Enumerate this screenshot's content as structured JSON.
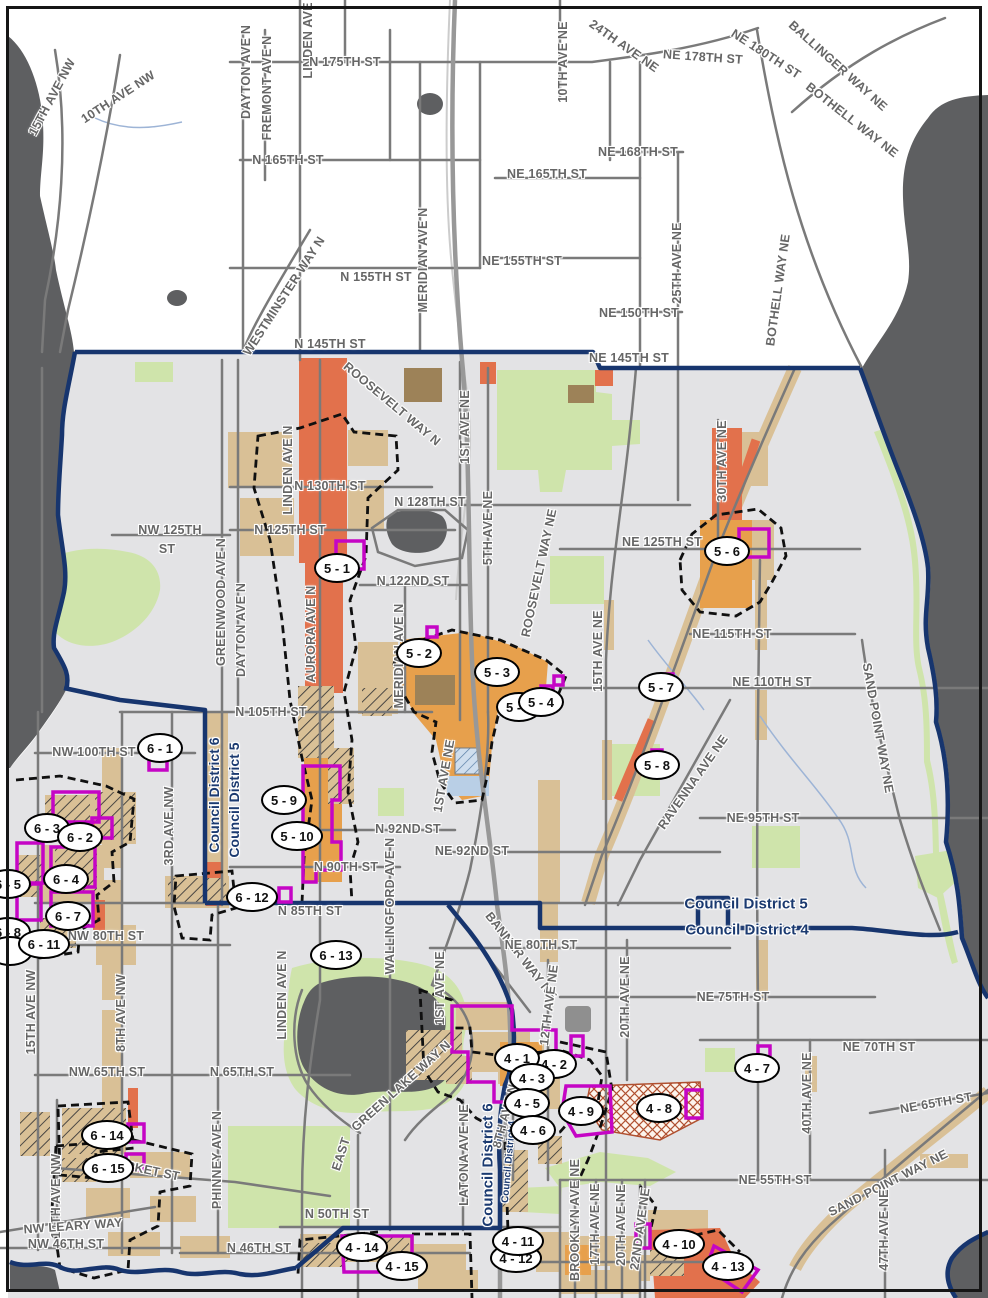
{
  "map": {
    "kind": "council-district-rezone-map",
    "colors": {
      "water": "#5e5f61",
      "city_background": "#e3e3e5",
      "outside_background": "#ffffff",
      "road": "#7a7a7a",
      "park_green": "#cfe4ab",
      "zone_tan": "#d9c096",
      "zone_orange": "#e2714c",
      "zone_amber": "#e7a04c",
      "zone_brown": "#9d8258",
      "district_boundary_navy": "#17356e",
      "zone_outline_purple": "#c505c5",
      "urban_village_dash": "#101010",
      "street_label_gray": "#666666",
      "district_label_blue": "#1b3a70",
      "stream_blue": "#9db4d6",
      "crosshatch_red": "#b05030",
      "school_blue": "#b9cfe6"
    }
  },
  "district_labels": [
    {
      "text": "Council District 6",
      "x": 214,
      "y": 795,
      "rot": -90,
      "size": 14
    },
    {
      "text": "Council District 5",
      "x": 234,
      "y": 800,
      "rot": -90,
      "size": 14
    },
    {
      "text": "Council District 5",
      "x": 746,
      "y": 904,
      "rot": 0,
      "size": 15
    },
    {
      "text": "Council District 4",
      "x": 747,
      "y": 930,
      "rot": 0,
      "size": 15
    },
    {
      "text": "Council District 6",
      "x": 488,
      "y": 1165,
      "rot": -90,
      "size": 15
    },
    {
      "text": "Council District 4",
      "x": 509,
      "y": 1162,
      "rot": -85,
      "size": 10
    }
  ],
  "street_labels": [
    {
      "text": "15TH AVE NW",
      "x": 52,
      "y": 97,
      "rot": -62
    },
    {
      "text": "10TH AVE NW",
      "x": 118,
      "y": 97,
      "rot": -33
    },
    {
      "text": "DAYTON AVE N",
      "x": 246,
      "y": 72,
      "rot": -90
    },
    {
      "text": "FREMONT AVE N",
      "x": 267,
      "y": 88,
      "rot": -90
    },
    {
      "text": "LINDEN AVE N",
      "x": 308,
      "y": 34,
      "rot": -90
    },
    {
      "text": "N 175TH ST",
      "x": 345,
      "y": 62,
      "rot": 0
    },
    {
      "text": "10TH AVE NE",
      "x": 563,
      "y": 62,
      "rot": -90
    },
    {
      "text": "24TH AVE NE",
      "x": 624,
      "y": 46,
      "rot": 35
    },
    {
      "text": "NE 178TH ST",
      "x": 703,
      "y": 57,
      "rot": 4
    },
    {
      "text": "NE 180TH ST",
      "x": 766,
      "y": 54,
      "rot": 33
    },
    {
      "text": "BALLINGER WAY NE",
      "x": 838,
      "y": 66,
      "rot": 42
    },
    {
      "text": "BOTHELL WAY NE",
      "x": 852,
      "y": 120,
      "rot": 38
    },
    {
      "text": "BOTHELL WAY NE",
      "x": 778,
      "y": 290,
      "rot": -82
    },
    {
      "text": "N 165TH ST",
      "x": 288,
      "y": 160,
      "rot": 0
    },
    {
      "text": "NE 168TH ST",
      "x": 638,
      "y": 152,
      "rot": 0
    },
    {
      "text": "NE 165TH ST",
      "x": 547,
      "y": 174,
      "rot": 0
    },
    {
      "text": "N 155TH ST",
      "x": 376,
      "y": 277,
      "rot": 0
    },
    {
      "text": "NE 155TH ST",
      "x": 522,
      "y": 261,
      "rot": 0
    },
    {
      "text": "NE 150TH ST",
      "x": 639,
      "y": 313,
      "rot": 0
    },
    {
      "text": "MERIDIAN AVE N",
      "x": 423,
      "y": 260,
      "rot": -90
    },
    {
      "text": "WESTMINSTER WAY N",
      "x": 284,
      "y": 296,
      "rot": -57
    },
    {
      "text": "N 145TH ST",
      "x": 330,
      "y": 344,
      "rot": 0
    },
    {
      "text": "NE 145TH ST",
      "x": 629,
      "y": 358,
      "rot": 0
    },
    {
      "text": "25TH AVE NE",
      "x": 677,
      "y": 263,
      "rot": -90
    },
    {
      "text": "ROOSEVELT WAY N",
      "x": 392,
      "y": 404,
      "rot": 40
    },
    {
      "text": "LINDEN AVE N",
      "x": 288,
      "y": 470,
      "rot": -90
    },
    {
      "text": "1ST AVE NE",
      "x": 465,
      "y": 427,
      "rot": -90
    },
    {
      "text": "5TH AVE NE",
      "x": 488,
      "y": 528,
      "rot": -90
    },
    {
      "text": "N 130TH ST",
      "x": 330,
      "y": 486,
      "rot": 0
    },
    {
      "text": "N 128TH ST",
      "x": 430,
      "y": 502,
      "rot": 0
    },
    {
      "text": "NW 125TH",
      "x": 170,
      "y": 530,
      "rot": 0
    },
    {
      "text": "ST",
      "x": 167,
      "y": 549,
      "rot": 0
    },
    {
      "text": "N 125TH ST",
      "x": 290,
      "y": 530,
      "rot": 0
    },
    {
      "text": "NE 125TH ST",
      "x": 662,
      "y": 542,
      "rot": 0
    },
    {
      "text": "N 122ND ST",
      "x": 413,
      "y": 581,
      "rot": 0
    },
    {
      "text": "GREENWOOD AVE N",
      "x": 221,
      "y": 602,
      "rot": -90
    },
    {
      "text": "DAYTON AVE N",
      "x": 241,
      "y": 630,
      "rot": -90
    },
    {
      "text": "AURORA AVE N",
      "x": 311,
      "y": 634,
      "rot": -90
    },
    {
      "text": "MERIDIAN AVE N",
      "x": 399,
      "y": 656,
      "rot": -90
    },
    {
      "text": "N 105TH ST",
      "x": 271,
      "y": 712,
      "rot": 0
    },
    {
      "text": "NW 100TH ST",
      "x": 94,
      "y": 752,
      "rot": 0
    },
    {
      "text": "30TH AVE NE",
      "x": 722,
      "y": 461,
      "rot": -90
    },
    {
      "text": "NE 115TH ST",
      "x": 732,
      "y": 634,
      "rot": 0
    },
    {
      "text": "NE 110TH ST",
      "x": 772,
      "y": 682,
      "rot": 0
    },
    {
      "text": "15TH AVE NE",
      "x": 598,
      "y": 651,
      "rot": -90
    },
    {
      "text": "ROOSEVELT WAY NE",
      "x": 539,
      "y": 573,
      "rot": -78
    },
    {
      "text": "SAND POINT WAY NE",
      "x": 878,
      "y": 728,
      "rot": 80
    },
    {
      "text": "RAVENNA AVE NE",
      "x": 693,
      "y": 782,
      "rot": -55
    },
    {
      "text": "NE 95TH ST",
      "x": 763,
      "y": 818,
      "rot": 0
    },
    {
      "text": "N 92ND ST",
      "x": 408,
      "y": 829,
      "rot": 0
    },
    {
      "text": "NE 92ND ST",
      "x": 472,
      "y": 851,
      "rot": 0
    },
    {
      "text": "N 90TH ST",
      "x": 346,
      "y": 867,
      "rot": 0
    },
    {
      "text": "WALLINGFORD AVE N",
      "x": 390,
      "y": 906,
      "rot": -90
    },
    {
      "text": "N 85TH ST",
      "x": 310,
      "y": 911,
      "rot": 0
    },
    {
      "text": "BANNER WAY NE",
      "x": 521,
      "y": 956,
      "rot": 52
    },
    {
      "text": "NE 80TH ST",
      "x": 541,
      "y": 945,
      "rot": 0
    },
    {
      "text": "NW 80TH ST",
      "x": 106,
      "y": 936,
      "rot": 0
    },
    {
      "text": "3RD AVE NW",
      "x": 169,
      "y": 826,
      "rot": -90
    },
    {
      "text": "8TH AVE NW",
      "x": 121,
      "y": 1013,
      "rot": -90
    },
    {
      "text": "15TH AVE NW",
      "x": 31,
      "y": 1012,
      "rot": -90
    },
    {
      "text": "LINDEN AVE N",
      "x": 282,
      "y": 995,
      "rot": -90
    },
    {
      "text": "1ST AVE NE",
      "x": 444,
      "y": 776,
      "rot": -80
    },
    {
      "text": "NE 75TH ST",
      "x": 733,
      "y": 997,
      "rot": 0
    },
    {
      "text": "NE 70TH ST",
      "x": 879,
      "y": 1047,
      "rot": 0
    },
    {
      "text": "NE 65TH ST",
      "x": 936,
      "y": 1103,
      "rot": -10
    },
    {
      "text": "40TH AVE NE",
      "x": 807,
      "y": 1093,
      "rot": -90
    },
    {
      "text": "NE 55TH ST",
      "x": 775,
      "y": 1180,
      "rot": 0
    },
    {
      "text": "SAND POINT WAY NE",
      "x": 888,
      "y": 1183,
      "rot": -27
    },
    {
      "text": "47TH AVE NE",
      "x": 884,
      "y": 1230,
      "rot": -90
    },
    {
      "text": "20TH AVE NE",
      "x": 625,
      "y": 997,
      "rot": -90
    },
    {
      "text": "12TH AVE NE",
      "x": 549,
      "y": 1005,
      "rot": -83
    },
    {
      "text": "1ST AVE NE",
      "x": 440,
      "y": 988,
      "rot": -90
    },
    {
      "text": "8TH AVE NE",
      "x": 506,
      "y": 1112,
      "rot": -75
    },
    {
      "text": "EAST",
      "x": 341,
      "y": 1154,
      "rot": -72
    },
    {
      "text": "GREEN LAKE WAY N",
      "x": 401,
      "y": 1086,
      "rot": -42
    },
    {
      "text": "LATONA AVE NE",
      "x": 464,
      "y": 1155,
      "rot": -90
    },
    {
      "text": "PHINNEY AVE N",
      "x": 217,
      "y": 1160,
      "rot": -90
    },
    {
      "text": "NW 65TH ST",
      "x": 107,
      "y": 1072,
      "rot": 0
    },
    {
      "text": "N 65TH ST",
      "x": 242,
      "y": 1072,
      "rot": 0
    },
    {
      "text": "MARKET ST",
      "x": 143,
      "y": 1169,
      "rot": 12
    },
    {
      "text": "14TH AVE NW",
      "x": 56,
      "y": 1196,
      "rot": -90
    },
    {
      "text": "NW LEARY WAY",
      "x": 73,
      "y": 1226,
      "rot": -4
    },
    {
      "text": "NW 46TH ST",
      "x": 66,
      "y": 1244,
      "rot": 0
    },
    {
      "text": "N 46TH ST",
      "x": 259,
      "y": 1248,
      "rot": 0
    },
    {
      "text": "N 50TH ST",
      "x": 337,
      "y": 1214,
      "rot": 0
    },
    {
      "text": "BROOKLYN AVE NE",
      "x": 575,
      "y": 1220,
      "rot": -90
    },
    {
      "text": "17TH AVE NE",
      "x": 595,
      "y": 1224,
      "rot": -90
    },
    {
      "text": "20TH AVE NE",
      "x": 621,
      "y": 1225,
      "rot": -90
    },
    {
      "text": "22ND AVE NE",
      "x": 640,
      "y": 1229,
      "rot": -82
    }
  ],
  "markers": [
    {
      "label": "6 - 3",
      "x": 47,
      "y": 828
    },
    {
      "label": "6 - 2",
      "x": 80,
      "y": 837
    },
    {
      "label": "6 - 5",
      "x": 8,
      "y": 884
    },
    {
      "label": "6 - 4",
      "x": 66,
      "y": 879
    },
    {
      "label": "6 - 7",
      "x": 68,
      "y": 916
    },
    {
      "label": "6 - 8",
      "x": 8,
      "y": 932
    },
    {
      "label": "",
      "x": 10,
      "y": 951,
      "blank": true
    },
    {
      "label": "6 - 11",
      "x": 44,
      "y": 944
    },
    {
      "label": "6 - 1",
      "x": 160,
      "y": 748
    },
    {
      "label": "6 - 12",
      "x": 252,
      "y": 897
    },
    {
      "label": "6 - 13",
      "x": 336,
      "y": 955
    },
    {
      "label": "6 - 14",
      "x": 107,
      "y": 1135
    },
    {
      "label": "6 - 15",
      "x": 108,
      "y": 1168
    },
    {
      "label": "5 - 1",
      "x": 337,
      "y": 568
    },
    {
      "label": "5 - 2",
      "x": 419,
      "y": 653
    },
    {
      "label": "5 - 3",
      "x": 497,
      "y": 672
    },
    {
      "label": "5 - 5",
      "x": 519,
      "y": 707
    },
    {
      "label": "5 - 4",
      "x": 541,
      "y": 702
    },
    {
      "label": "5 - 6",
      "x": 727,
      "y": 551
    },
    {
      "label": "5 - 7",
      "x": 661,
      "y": 687
    },
    {
      "label": "5 - 8",
      "x": 657,
      "y": 765
    },
    {
      "label": "5 - 9",
      "x": 284,
      "y": 800
    },
    {
      "label": "5 - 10",
      "x": 297,
      "y": 836
    },
    {
      "label": "4 - 2",
      "x": 554,
      "y": 1064
    },
    {
      "label": "4 - 1",
      "x": 517,
      "y": 1058
    },
    {
      "label": "4 - 3",
      "x": 532,
      "y": 1078
    },
    {
      "label": "4 - 5",
      "x": 527,
      "y": 1103
    },
    {
      "label": "4 - 6",
      "x": 533,
      "y": 1130
    },
    {
      "label": "4 - 9",
      "x": 581,
      "y": 1111
    },
    {
      "label": "4 - 8",
      "x": 659,
      "y": 1108
    },
    {
      "label": "4 - 7",
      "x": 757,
      "y": 1068
    },
    {
      "label": "4 - 12",
      "x": 516,
      "y": 1258
    },
    {
      "label": "4 - 11",
      "x": 518,
      "y": 1241
    },
    {
      "label": "4 - 10",
      "x": 679,
      "y": 1244
    },
    {
      "label": "4 - 14",
      "x": 362,
      "y": 1247
    },
    {
      "label": "4 - 15",
      "x": 402,
      "y": 1266
    },
    {
      "label": "4 - 13",
      "x": 728,
      "y": 1266
    }
  ]
}
